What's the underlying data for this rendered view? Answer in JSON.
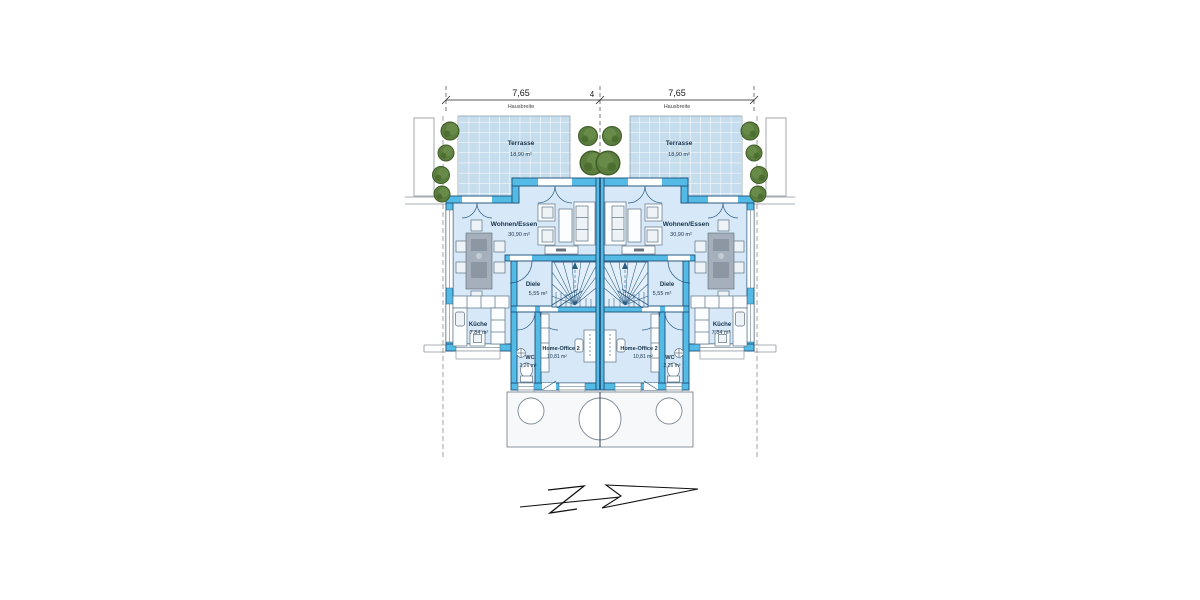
{
  "plan": {
    "title": "semi-detached-house-floor-plan",
    "dimension_row": {
      "left_house_width": "7,65",
      "separation_joint": "4",
      "right_house_width": "7,65",
      "width_caption": "Hausbreite"
    },
    "rooms": {
      "terrasse": {
        "name": "Terrasse",
        "area": "18,90 m²"
      },
      "wohnen_essen": {
        "name": "Wohnen/Essen",
        "area": "30,90 m²"
      },
      "diele": {
        "name": "Diele",
        "area": "5,55 m²"
      },
      "kueche": {
        "name": "Küche",
        "area": "7,84 m²"
      },
      "wc": {
        "name": "WC",
        "area": "2,26 m²"
      },
      "home_office": {
        "name": "Home-Office 2",
        "area": "10,81 m²"
      }
    },
    "colors": {
      "wall_fill": "#53bbe6",
      "wall_outline": "#1e5078",
      "floor": "#d7e9f8",
      "terrace_fill": "#c6ddee",
      "terrace_grid": "#ffffff",
      "shrub_green": "#5b7d3e",
      "porch_outline": "#7d8894"
    },
    "glyphs": {
      "north_arrow": "stylized arrow pointing right",
      "shrub": "green foliage circle"
    }
  }
}
